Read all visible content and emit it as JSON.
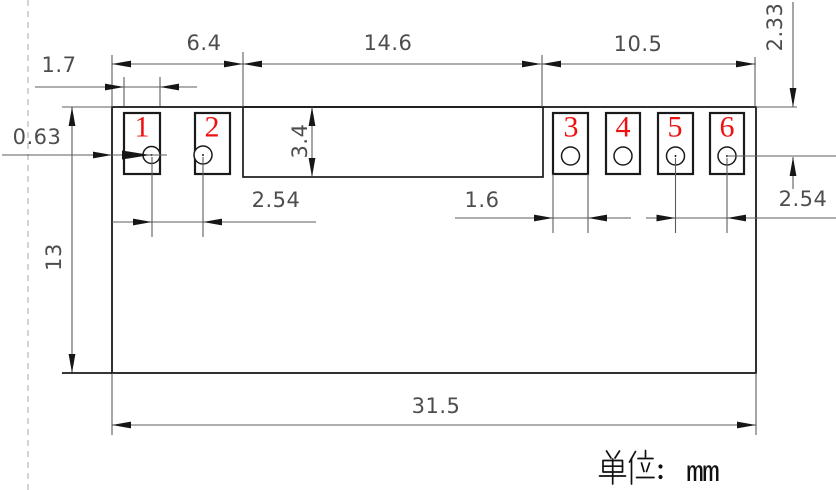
{
  "drawing": {
    "width": 836,
    "height": 490,
    "background": "#ffffff",
    "unit_note": {
      "text": "单位：mm",
      "latin_part": "mm"
    },
    "colors": {
      "outline": "#1a1a1a",
      "dimension": "#5c5c5c",
      "dim_text": "#4d4d4d",
      "pad_number": "#ee1111",
      "dashed_border": "#b8b8b8",
      "unit_text": "#111111"
    },
    "dim_labels": [
      {
        "id": "dim-6-4",
        "text": "6.4",
        "x": 204,
        "y": 43
      },
      {
        "id": "dim-14-6",
        "text": "14.6",
        "x": 388,
        "y": 43
      },
      {
        "id": "dim-10-5",
        "text": "10.5",
        "x": 638,
        "y": 44
      },
      {
        "id": "dim-1-7",
        "text": "1.7",
        "x": 59,
        "y": 65
      },
      {
        "id": "dim-0-63",
        "text": "0.63",
        "x": 37,
        "y": 137
      },
      {
        "id": "dim-3-4",
        "text": "3.4",
        "x": 300,
        "y": 141,
        "rot": -90
      },
      {
        "id": "dim-13",
        "text": "13",
        "x": 54,
        "y": 257,
        "rot": -90
      },
      {
        "id": "dim-2-33",
        "text": "2.33",
        "x": 775,
        "y": 27,
        "rot": -90
      },
      {
        "id": "dim-2-54-left",
        "text": "2.54",
        "x": 276,
        "y": 200
      },
      {
        "id": "dim-1-6",
        "text": "1.6",
        "x": 482,
        "y": 200
      },
      {
        "id": "dim-2-54-right",
        "text": "2.54",
        "x": 803,
        "y": 199
      },
      {
        "id": "dim-31-5",
        "text": "31.5",
        "x": 436,
        "y": 406
      }
    ],
    "body": {
      "outer": {
        "x": 112,
        "y": 107,
        "w": 644,
        "h": 266
      },
      "notch": {
        "x": 243,
        "y": 107,
        "w": 300,
        "h": 70
      }
    },
    "pads": [
      {
        "num": "1",
        "x": 124,
        "y": 113,
        "w": 36,
        "h": 61,
        "hole": {
          "cx": 151.5,
          "cy": 155,
          "r": 8.5
        },
        "dot": true,
        "num_x": 142,
        "num_y": 127
      },
      {
        "num": "2",
        "x": 195,
        "y": 113,
        "w": 35,
        "h": 61,
        "hole": {
          "cx": 203,
          "cy": 155,
          "r": 9
        },
        "dot": true,
        "num_x": 212,
        "num_y": 127
      },
      {
        "num": "3",
        "x": 553,
        "y": 113,
        "w": 35,
        "h": 61,
        "hole": {
          "cx": 570.5,
          "cy": 156,
          "r": 9
        },
        "dot": false,
        "num_x": 571,
        "num_y": 127
      },
      {
        "num": "4",
        "x": 606,
        "y": 113,
        "w": 34,
        "h": 61,
        "hole": {
          "cx": 623,
          "cy": 156,
          "r": 9
        },
        "dot": false,
        "num_x": 623,
        "num_y": 127
      },
      {
        "num": "5",
        "x": 658,
        "y": 113,
        "w": 35,
        "h": 61,
        "hole": {
          "cx": 675.5,
          "cy": 156,
          "r": 9
        },
        "dot": true,
        "num_x": 675,
        "num_y": 127
      },
      {
        "num": "6",
        "x": 710,
        "y": 113,
        "w": 34,
        "h": 61,
        "hole": {
          "cx": 727,
          "cy": 156,
          "r": 9
        },
        "dot": true,
        "num_x": 727,
        "num_y": 127
      }
    ],
    "thin_lines": [
      [
        112,
        55,
        112,
        107
      ],
      [
        243,
        52,
        243,
        107
      ],
      [
        542,
        55,
        542,
        107
      ],
      [
        755,
        57,
        755,
        107
      ],
      [
        124,
        77,
        124,
        106
      ],
      [
        160,
        77,
        160,
        106
      ],
      [
        112,
        64,
        756,
        64
      ],
      [
        35,
        87,
        197,
        87
      ],
      [
        2,
        155,
        167,
        155
      ],
      [
        62,
        107,
        112,
        107
      ],
      [
        756,
        107,
        797,
        107
      ],
      [
        727,
        156,
        836,
        156
      ],
      [
        72,
        107,
        72,
        373
      ],
      [
        312,
        107,
        312,
        177
      ],
      [
        793,
        2,
        793,
        107
      ],
      [
        793,
        157,
        793,
        189
      ],
      [
        112,
        222,
        316,
        222
      ],
      [
        152,
        157,
        152,
        237
      ],
      [
        203,
        157,
        203,
        237
      ],
      [
        455,
        218,
        631,
        218
      ],
      [
        646,
        218,
        836,
        218
      ],
      [
        553,
        174,
        553,
        233
      ],
      [
        588,
        174,
        588,
        233
      ],
      [
        675.5,
        158,
        675.5,
        233
      ],
      [
        727,
        158,
        727,
        233
      ],
      [
        112,
        425,
        756,
        425
      ],
      [
        112,
        373,
        112,
        435
      ],
      [
        756,
        373,
        756,
        435
      ]
    ],
    "dark_lines": [
      [
        62,
        373,
        112,
        373
      ]
    ],
    "dashed_lines": [
      [
        28,
        0,
        28,
        490
      ]
    ],
    "arrows": [
      {
        "x": 112,
        "y": 64,
        "dir": "left"
      },
      {
        "x": 243,
        "y": 64,
        "dir": "right"
      },
      {
        "x": 243,
        "y": 64,
        "dir": "left"
      },
      {
        "x": 541,
        "y": 64,
        "dir": "right"
      },
      {
        "x": 542,
        "y": 64,
        "dir": "left"
      },
      {
        "x": 755,
        "y": 64,
        "dir": "right"
      },
      {
        "x": 124,
        "y": 87,
        "dir": "right"
      },
      {
        "x": 160,
        "y": 87,
        "dir": "left"
      },
      {
        "x": 112,
        "y": 155,
        "dir": "right"
      },
      {
        "x": 150,
        "y": 155,
        "dir": "right",
        "len": 28,
        "hw": 4.5
      },
      {
        "x": 72,
        "y": 107,
        "dir": "up"
      },
      {
        "x": 72,
        "y": 373,
        "dir": "down"
      },
      {
        "x": 312,
        "y": 107,
        "dir": "up"
      },
      {
        "x": 312,
        "y": 177,
        "dir": "down"
      },
      {
        "x": 793,
        "y": 107,
        "dir": "down"
      },
      {
        "x": 793,
        "y": 157,
        "dir": "up"
      },
      {
        "x": 152,
        "y": 222,
        "dir": "right"
      },
      {
        "x": 203,
        "y": 222,
        "dir": "left"
      },
      {
        "x": 553,
        "y": 218,
        "dir": "right"
      },
      {
        "x": 588,
        "y": 218,
        "dir": "left"
      },
      {
        "x": 675.5,
        "y": 218,
        "dir": "right"
      },
      {
        "x": 727,
        "y": 218,
        "dir": "left"
      },
      {
        "x": 112,
        "y": 425,
        "dir": "left"
      },
      {
        "x": 756,
        "y": 425,
        "dir": "right"
      }
    ]
  }
}
